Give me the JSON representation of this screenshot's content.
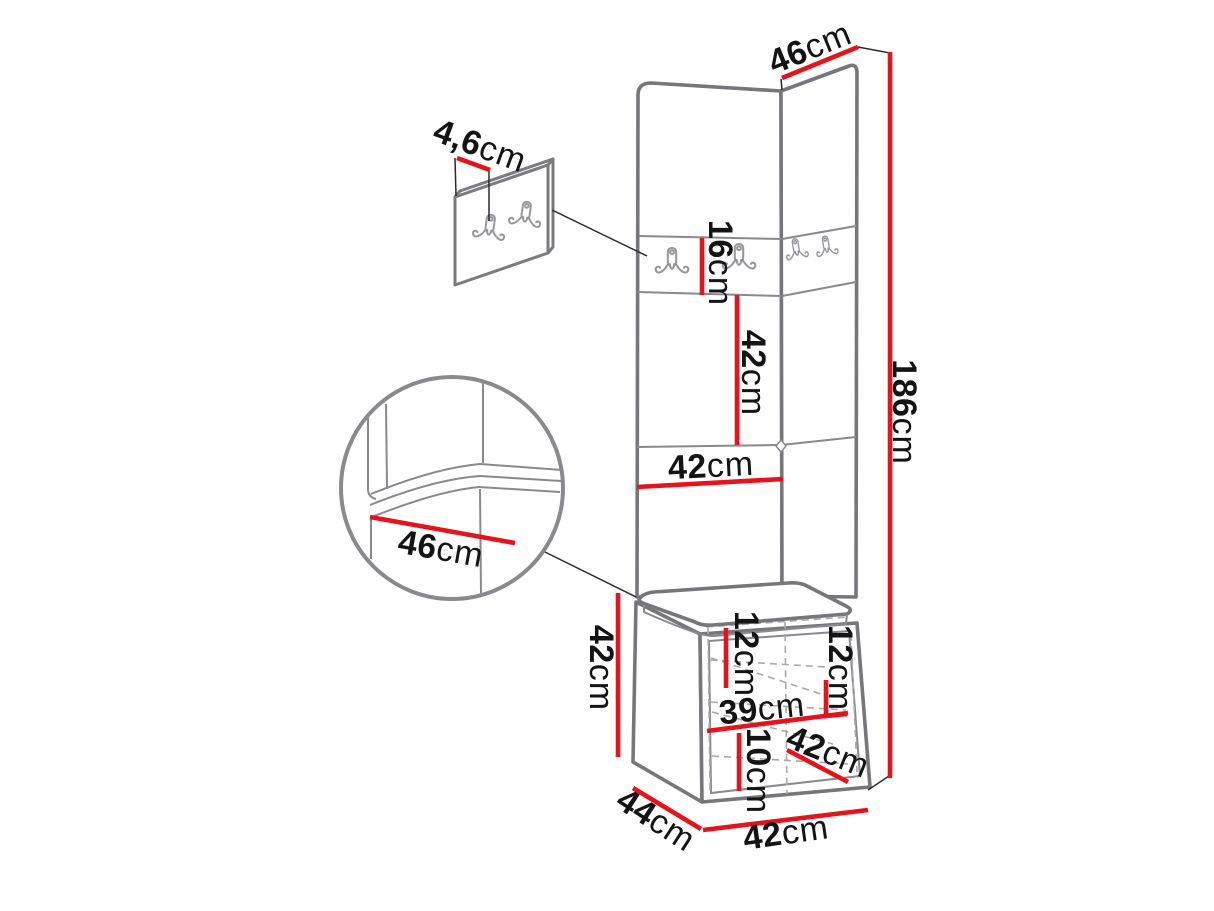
{
  "page": {
    "background": "#ffffff",
    "description": "Furniture dimension diagram of a corner hallway unit: tall upholstered wall panels with coat hooks, bench seat cushion and open shoe cabinet, with red dimension lines"
  },
  "colors": {
    "dimension_red": "#e8121a",
    "outline_gray": "#7b7b80",
    "dash_gray": "#aaaaae",
    "text_black": "#141414",
    "leader_black": "#2b2b2b"
  },
  "dimensions": {
    "top_width": {
      "value": "46",
      "unit": "cm"
    },
    "hook_panel_depth": {
      "value": "4,6",
      "unit": "cm"
    },
    "hook_strip_height": {
      "value": "16",
      "unit": "cm"
    },
    "upper_panel_height": {
      "value": "42",
      "unit": "cm"
    },
    "panel_width": {
      "value": "42",
      "unit": "cm"
    },
    "total_height": {
      "value": "186",
      "unit": "cm"
    },
    "seat_depth": {
      "value": "46",
      "unit": "cm"
    },
    "cabinet_height": {
      "value": "42",
      "unit": "cm"
    },
    "niche_height_left": {
      "value": "12",
      "unit": "cm"
    },
    "niche_height_right": {
      "value": "12",
      "unit": "cm"
    },
    "shelf_width": {
      "value": "39",
      "unit": "cm"
    },
    "bottom_niche_height": {
      "value": "10",
      "unit": "cm"
    },
    "inner_depth": {
      "value": "42",
      "unit": "cm"
    },
    "base_depth": {
      "value": "44",
      "unit": "cm"
    },
    "base_width": {
      "value": "42",
      "unit": "cm"
    }
  }
}
